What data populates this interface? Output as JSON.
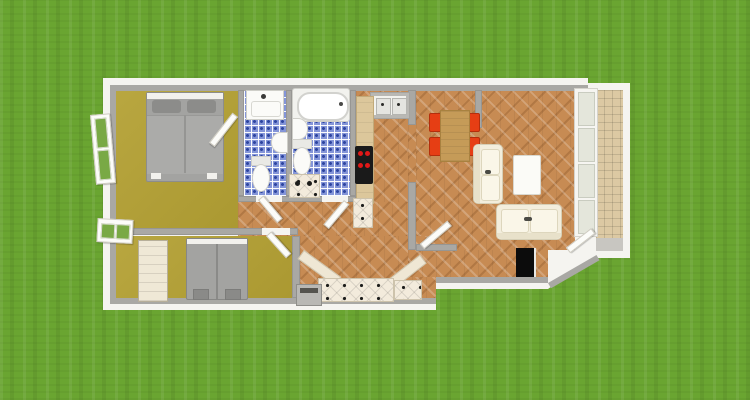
{
  "scene": {
    "type": "3d-floor-plan-render",
    "setting": "apartment top-down 3D render on grass lawn",
    "rooms": [
      {
        "name": "bedroom-1",
        "floor": "olive",
        "contents": [
          "double-bed",
          "open-window"
        ]
      },
      {
        "name": "wc-bathroom",
        "floor": "blue-checker-tile",
        "contents": [
          "washbasin",
          "bidet",
          "toilet"
        ]
      },
      {
        "name": "main-bathroom",
        "floor": "blue-checker-tile",
        "contents": [
          "bathtub",
          "wall-sink",
          "toilet",
          "washer-cabinet"
        ]
      },
      {
        "name": "kitchen",
        "floor": "herringbone-wood",
        "contents": [
          "double-sink-unit",
          "counter",
          "cooktop-4-burners"
        ]
      },
      {
        "name": "living-dining-room",
        "floor": "herringbone-wood",
        "contents": [
          "dining-table",
          "red-chairs-x4",
          "sofa",
          "loveseat",
          "coffee-table"
        ]
      },
      {
        "name": "hallway-entrance",
        "floor": "herringbone-wood",
        "contents": [
          "front-door-black"
        ]
      },
      {
        "name": "kitchen-nook",
        "floor": "herringbone-wood",
        "contents": [
          "diamond-counter",
          "appliance"
        ]
      },
      {
        "name": "bedroom-2",
        "floor": "olive",
        "contents": [
          "double-bed",
          "wardrobe",
          "window"
        ]
      },
      {
        "name": "balcony",
        "floor": "tan-tile",
        "contents": [
          "french-door"
        ]
      }
    ]
  },
  "colors": {
    "grass": "#6aa531",
    "wall_white": "#f5f4f0",
    "wall_gray": "#a9a8a4",
    "floor_bedroom": "#b4a134",
    "floor_wood": "#c78b53",
    "tile_blue": "#8495d8",
    "tile_balcony": "#dcc9a3",
    "counter_cream": "#f3ebdc",
    "counter_tan": "#dcc79b",
    "chair_red": "#e63e14",
    "table_wood": "#c59b58",
    "sofa_cream": "#f3eedd",
    "bed_gray": "#a3a3a1",
    "door_black": "#0c0c0c",
    "cooktop_black": "#1a1a1a",
    "burner_red": "#e01818",
    "appliance_gray": "#b9b8b4",
    "wardrobe_cream": "#efe8d6",
    "fixture_white": "#fbfbf8"
  }
}
